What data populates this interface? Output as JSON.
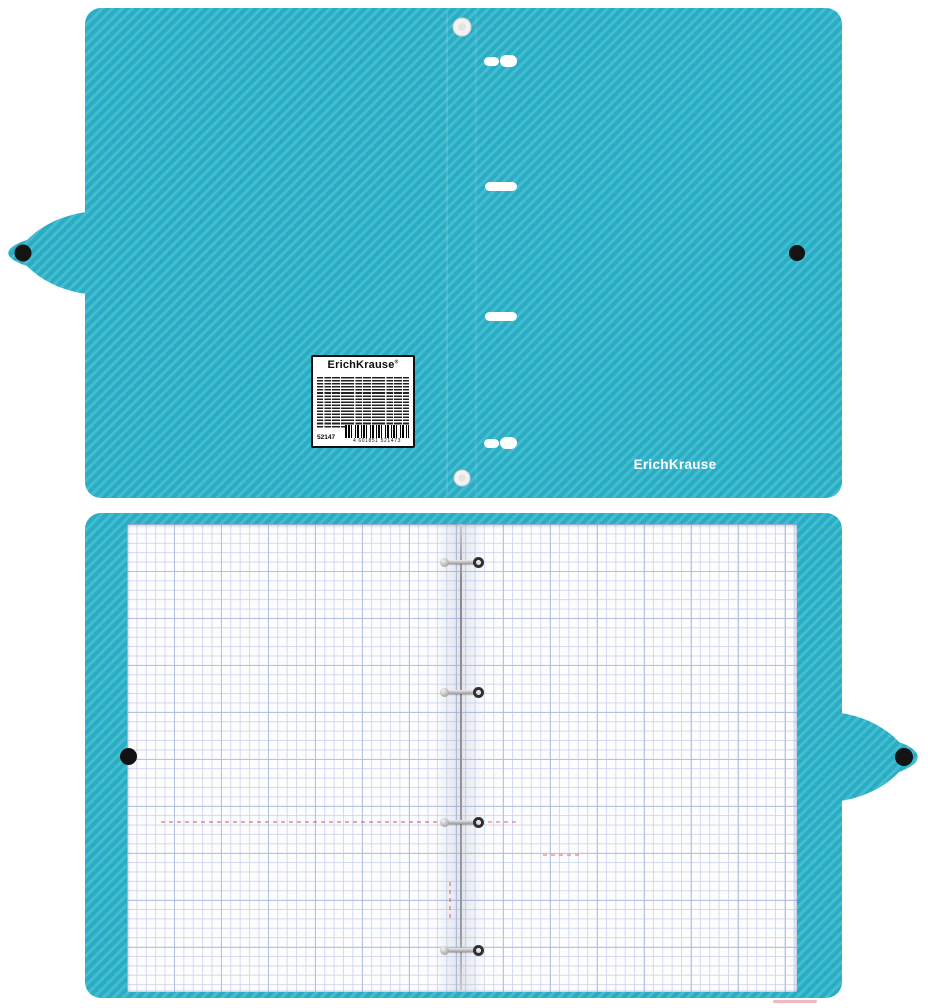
{
  "brand": {
    "cover_logo_text": "ErichKrause"
  },
  "label": {
    "title": "ErichKrause",
    "trademark": "®",
    "article_number": "52147",
    "barcode_digits": "4 601851 521473"
  },
  "colors": {
    "cover_teal": "#2AACC4",
    "cover_stripe_light": "#43BED0",
    "snap_black": "#141414",
    "rivet_white": "#F2F2F2",
    "page_white": "#FDFDFE",
    "grid_minor": "#CDD6EE",
    "grid_major": "#AAB8DE",
    "margin_red": "#E05A6E",
    "ring_metal": "#9B9B9B",
    "label_bg": "#FFFFFF",
    "label_border": "#101010"
  },
  "icons": {
    "snap_button_glyph": "●",
    "rivet_glyph": "○",
    "binding_slot_glyph": "▬",
    "binder_ring_glyph": "⊙",
    "barcode_glyph": "▮▯▮▯▮"
  }
}
